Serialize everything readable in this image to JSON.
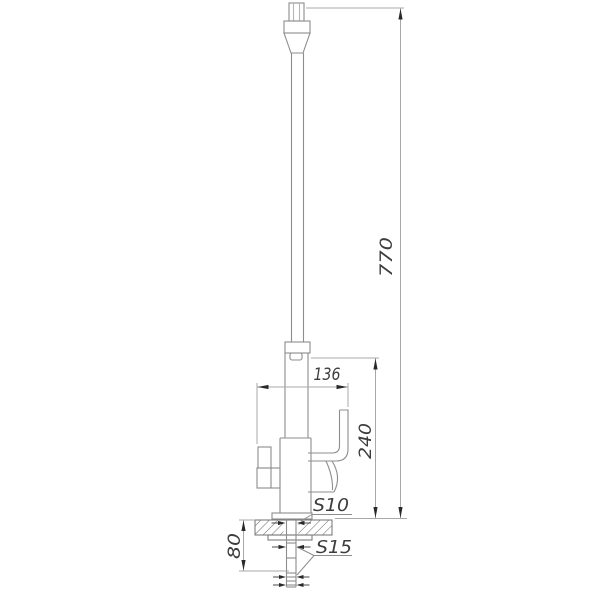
{
  "drawing": {
    "type": "technical-dimension-drawing",
    "subject": "kitchen faucet, front elevation with mounting stem",
    "dims": {
      "total_height": "770",
      "body_height": "240",
      "overall_width": "136",
      "under_counter_length": "80"
    },
    "labels": {
      "hex_body": "S10",
      "hex_stem": "S15"
    },
    "colors": {
      "object_line": "#8d8d8d",
      "dimension_line": "#a8a8a8",
      "hatch_line": "#6a6a6a",
      "annotation": "#2a2a2a",
      "background": "#ffffff"
    }
  }
}
